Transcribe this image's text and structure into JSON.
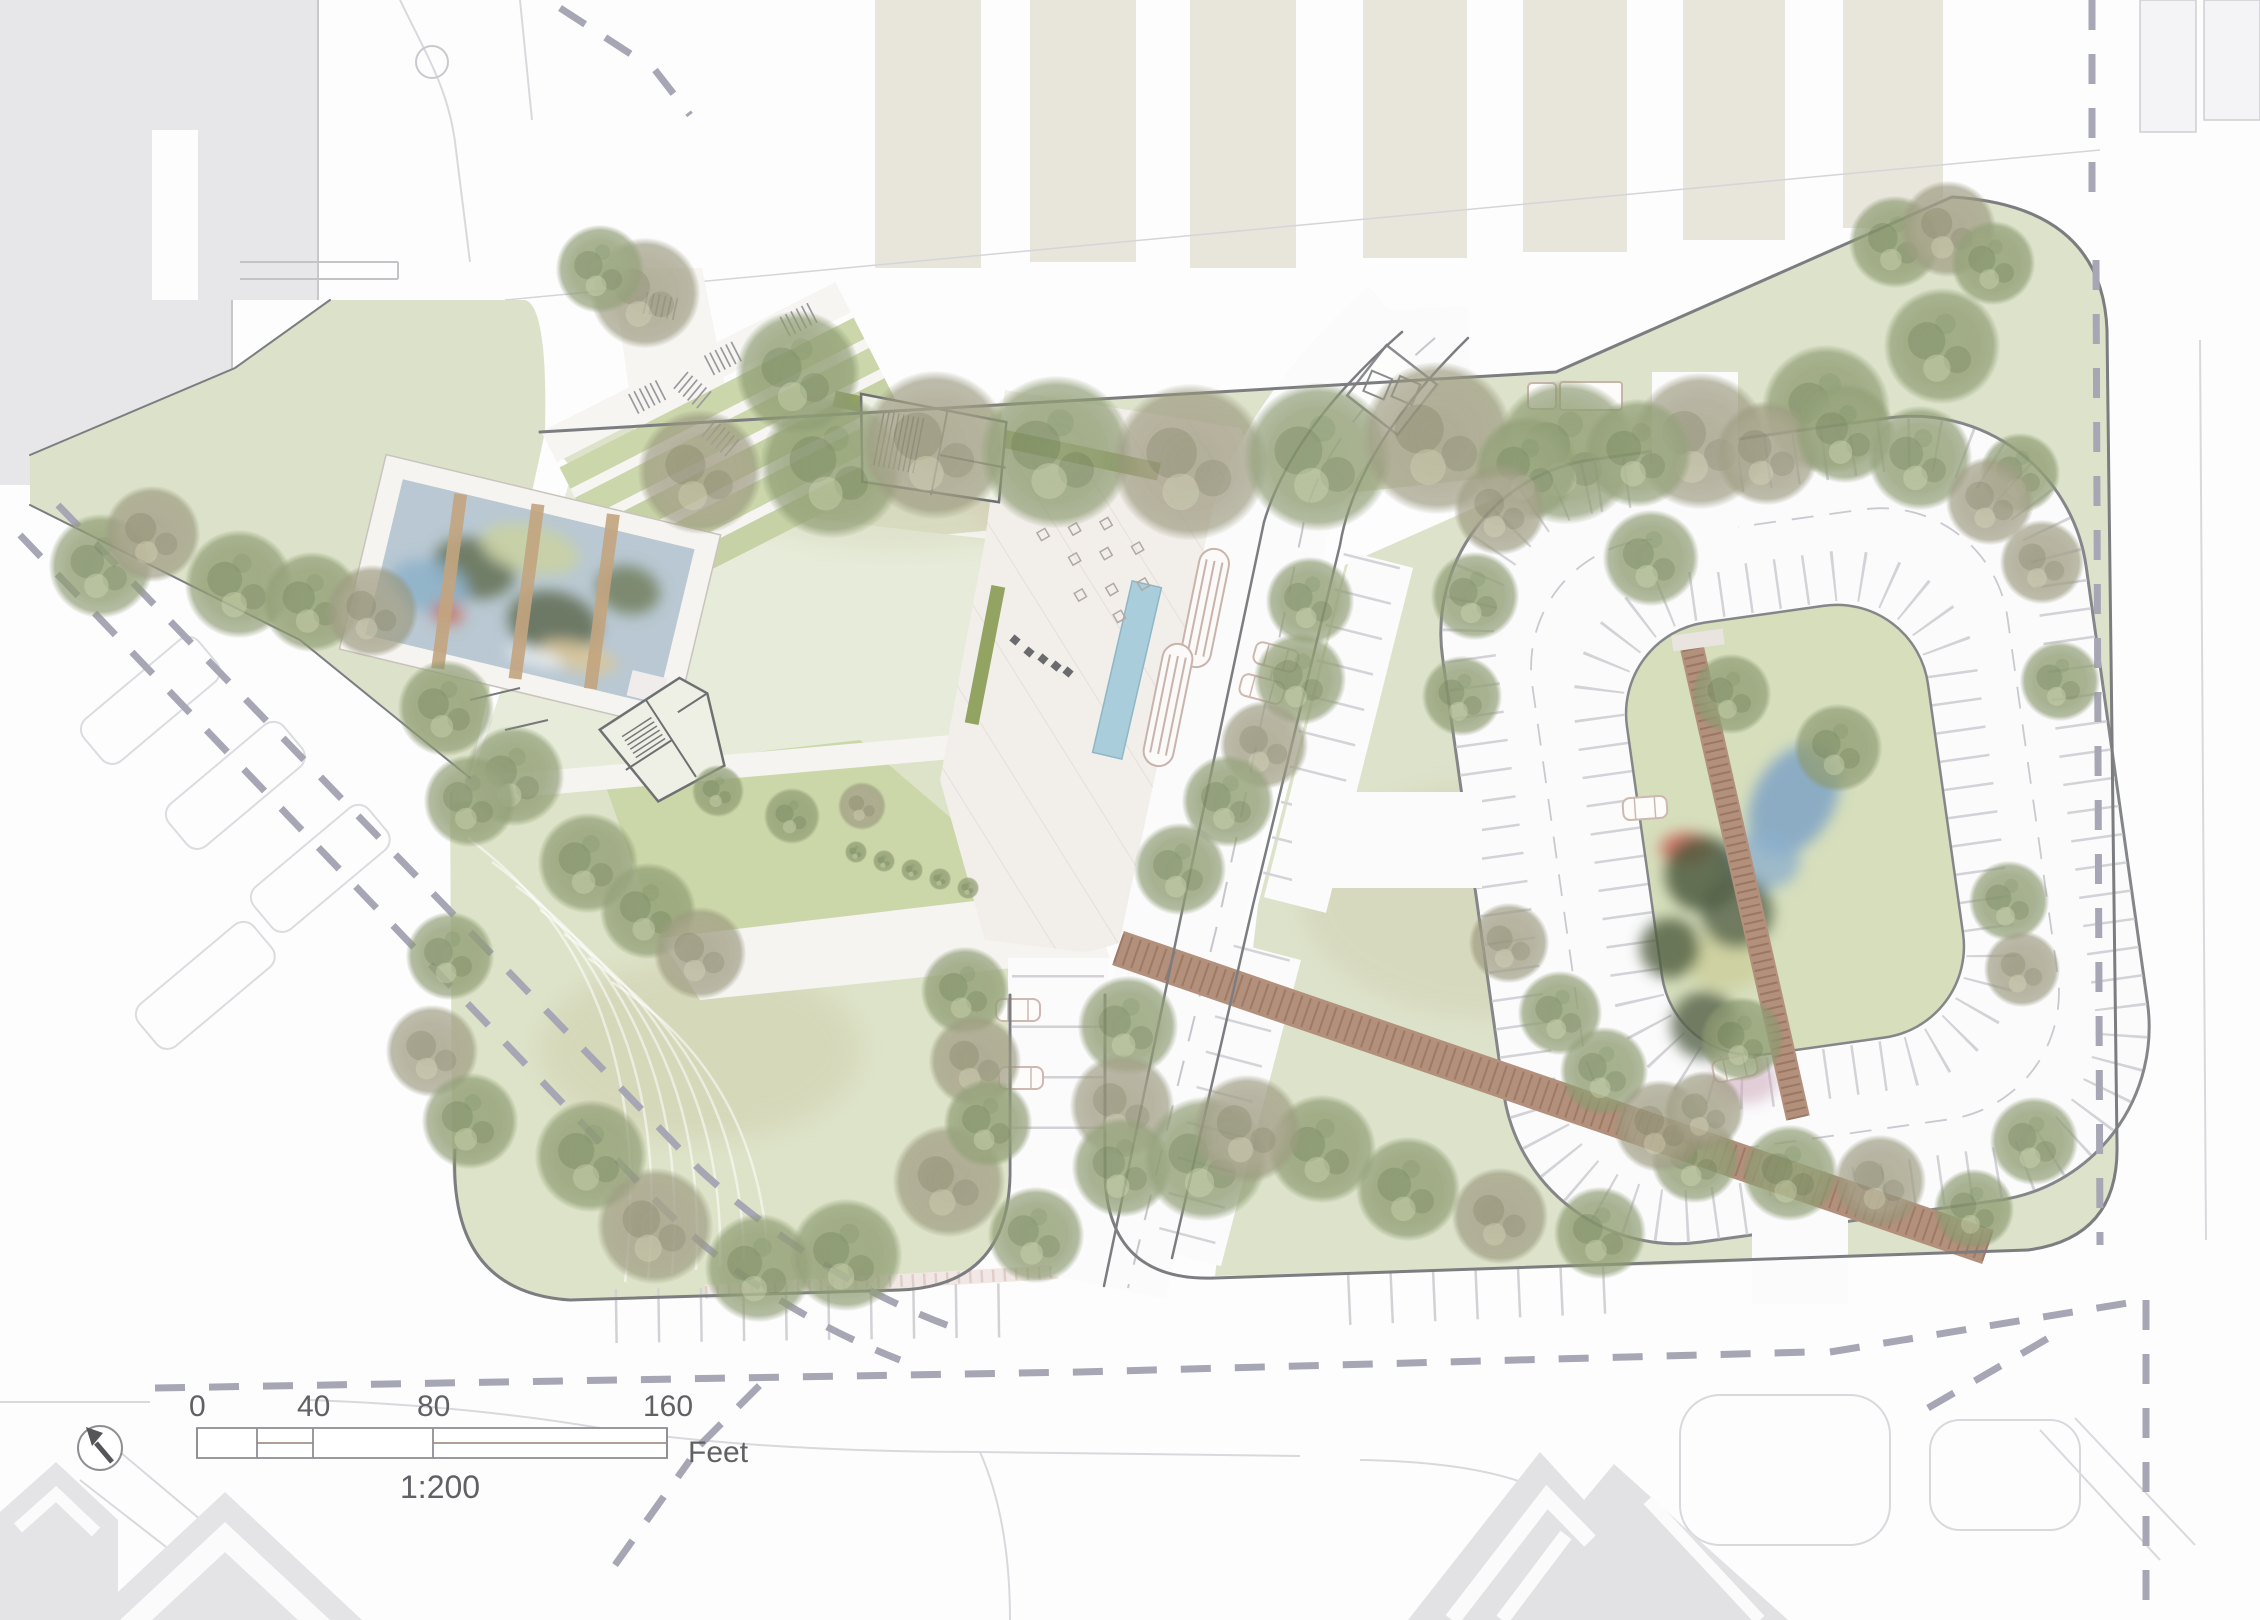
{
  "plan": {
    "type": "landscape-architecture-site-plan",
    "scale_bar": {
      "ticks": [
        {
          "label": "0",
          "x": 197
        },
        {
          "label": "40",
          "x": 313
        },
        {
          "label": "80",
          "x": 433
        },
        {
          "label": "160",
          "x": 667
        }
      ],
      "unit": "Feet",
      "ratio": "1:200"
    },
    "north_arrow": {
      "icon": "northwest-arrow"
    },
    "colors": {
      "site_green": "#dde3cb",
      "lawn_green": "#e6ecd9",
      "bed_green": "#ccd7a9",
      "island_green": "#d6debc",
      "canopy_olive": "#93a077",
      "canopy_brown": "#a5a189",
      "hedge_green": "#93a361",
      "pool_blue": "#a9cdda",
      "boardwalk_brown": "#b2907b",
      "plank_brown": "#9a7763",
      "pavement_pink": "#f2eeea",
      "beige_building": "#e8e5db",
      "context_gray": "#e6e6e9",
      "curb_gray": "#85868a",
      "dash_gray": "#a6a6b4",
      "water_blue": "#b9c8d2",
      "playground_blue": "#7fa3c6",
      "accent_red": "#cc6f63",
      "label_gray": "#606065"
    },
    "features": [
      "context-buildings-row-north",
      "context-building-northwest",
      "street-tree-row",
      "terraced-garden-beds",
      "sunken-water-garden",
      "central-lawn",
      "plaza-with-lap-pool",
      "cafe-terrace",
      "pavilion-footprints",
      "oval-parking-ring",
      "parking-island-playground",
      "island-boardwalk",
      "diagonal-boardwalk",
      "southwest-meadow",
      "bus-bays",
      "parking-stalls",
      "property-dashed-lines",
      "context-buildings-south"
    ],
    "trees": [
      [
        700,
        472,
        62,
        1
      ],
      [
        832,
        466,
        72,
        0
      ],
      [
        935,
        445,
        74,
        1
      ],
      [
        1056,
        452,
        76,
        0
      ],
      [
        1190,
        462,
        78,
        1
      ],
      [
        1318,
        457,
        74,
        0
      ],
      [
        1437,
        438,
        76,
        1
      ],
      [
        1566,
        452,
        72,
        0
      ],
      [
        1700,
        441,
        68,
        1
      ],
      [
        1826,
        409,
        64,
        0
      ],
      [
        1942,
        346,
        58,
        0
      ],
      [
        1895,
        242,
        46,
        0
      ],
      [
        1948,
        229,
        48,
        1
      ],
      [
        1993,
        263,
        42,
        0
      ],
      [
        2020,
        473,
        40,
        0
      ],
      [
        2042,
        562,
        42,
        1
      ],
      [
        2060,
        681,
        40,
        0
      ],
      [
        2009,
        901,
        40,
        0
      ],
      [
        2022,
        969,
        38,
        1
      ],
      [
        2034,
        1141,
        44,
        0
      ],
      [
        1974,
        1209,
        40,
        0
      ],
      [
        1880,
        1181,
        46,
        1
      ],
      [
        1790,
        1173,
        48,
        0
      ],
      [
        1695,
        1159,
        44,
        0
      ],
      [
        1600,
        1233,
        46,
        0
      ],
      [
        1500,
        1216,
        48,
        1
      ],
      [
        1408,
        1189,
        52,
        0
      ],
      [
        1322,
        1149,
        54,
        0
      ],
      [
        1527,
        468,
        52,
        0
      ],
      [
        1500,
        509,
        46,
        1
      ],
      [
        1638,
        453,
        54,
        0
      ],
      [
        1651,
        558,
        48,
        0
      ],
      [
        1767,
        453,
        52,
        1
      ],
      [
        1845,
        433,
        50,
        0
      ],
      [
        1920,
        458,
        52,
        0
      ],
      [
        1990,
        501,
        44,
        1
      ],
      [
        1475,
        596,
        44,
        0
      ],
      [
        1462,
        696,
        40,
        0
      ],
      [
        1509,
        943,
        40,
        1
      ],
      [
        1560,
        1013,
        42,
        0
      ],
      [
        1604,
        1071,
        44,
        0
      ],
      [
        1660,
        1126,
        46,
        1
      ],
      [
        1731,
        694,
        40,
        0
      ],
      [
        1838,
        748,
        44,
        0
      ],
      [
        1742,
        1039,
        42,
        0
      ],
      [
        1704,
        1111,
        40,
        1
      ],
      [
        1128,
        1026,
        50,
        0
      ],
      [
        1122,
        1106,
        52,
        1
      ],
      [
        1122,
        1167,
        50,
        0
      ],
      [
        1205,
        1159,
        62,
        0
      ],
      [
        1247,
        1129,
        54,
        1
      ],
      [
        1310,
        601,
        44,
        0
      ],
      [
        1300,
        679,
        46,
        0
      ],
      [
        1264,
        745,
        44,
        1
      ],
      [
        1228,
        801,
        46,
        0
      ],
      [
        1180,
        869,
        46,
        0
      ],
      [
        101,
        566,
        52,
        0
      ],
      [
        152,
        534,
        48,
        1
      ],
      [
        239,
        584,
        54,
        0
      ],
      [
        312,
        602,
        50,
        0
      ],
      [
        372,
        611,
        46,
        1
      ],
      [
        446,
        708,
        48,
        0
      ],
      [
        514,
        776,
        50,
        0
      ],
      [
        591,
        1156,
        56,
        0
      ],
      [
        655,
        1226,
        58,
        1
      ],
      [
        759,
        1268,
        54,
        0
      ],
      [
        846,
        1255,
        56,
        0
      ],
      [
        949,
        1181,
        56,
        1
      ],
      [
        588,
        863,
        50,
        0
      ],
      [
        648,
        911,
        48,
        0
      ],
      [
        700,
        953,
        46,
        1
      ],
      [
        470,
        801,
        46,
        0
      ],
      [
        450,
        956,
        44,
        0
      ],
      [
        432,
        1051,
        46,
        1
      ],
      [
        470,
        1121,
        48,
        0
      ],
      [
        1036,
        1235,
        48,
        0
      ],
      [
        965,
        991,
        44,
        0
      ],
      [
        975,
        1061,
        46,
        1
      ],
      [
        988,
        1123,
        44,
        0
      ],
      [
        798,
        373,
        62,
        0
      ],
      [
        645,
        293,
        55,
        1
      ],
      [
        600,
        269,
        44,
        0
      ],
      [
        718,
        791,
        26,
        0
      ],
      [
        792,
        816,
        28,
        0
      ],
      [
        862,
        806,
        24,
        1
      ],
      [
        856,
        852,
        11,
        0
      ],
      [
        884,
        861,
        11,
        0
      ],
      [
        912,
        870,
        11,
        0
      ],
      [
        940,
        879,
        11,
        0
      ],
      [
        968,
        888,
        11,
        0
      ]
    ]
  }
}
